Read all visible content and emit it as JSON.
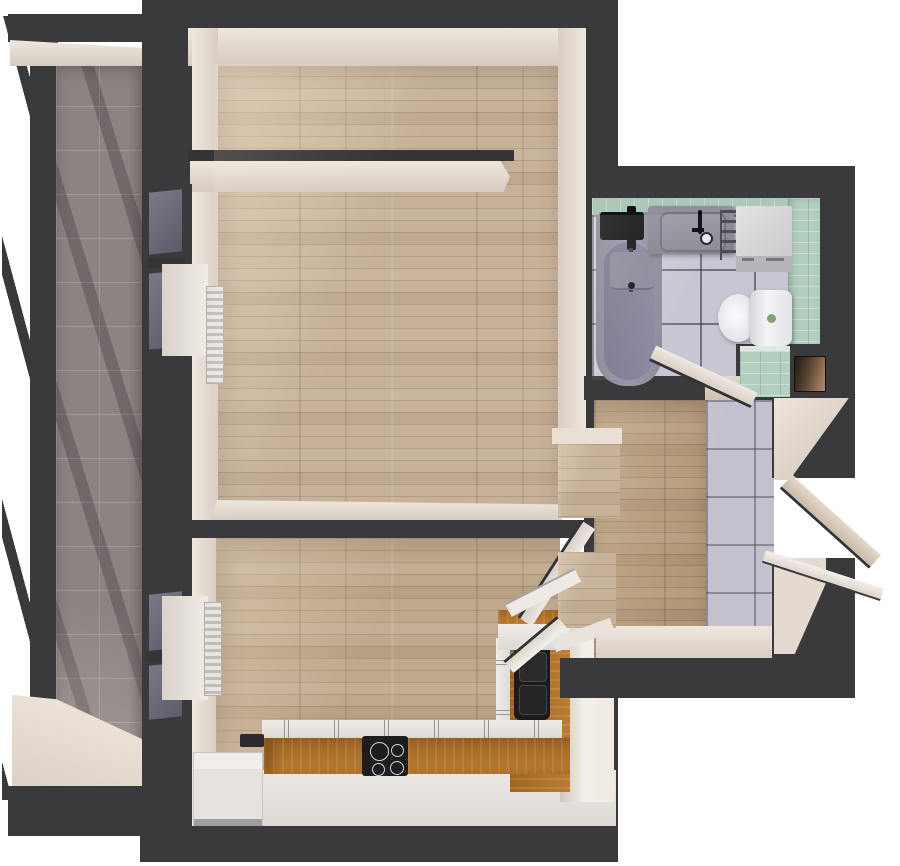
{
  "scene": {
    "description": "Top-down 3D render of a one-bedroom apartment floor plan",
    "background": "#ffffff",
    "view": "plan render, cut walls shown dark grey"
  },
  "palette": {
    "wall_cut": "#3a393b",
    "wall_face": "#e9dfd5",
    "wood_floor": "#c7b199",
    "hall_wood": "#b29878",
    "balcony_tile": "#8c8382",
    "bath_tile": "#c7c6d2",
    "green_tile": "#b2cfc0",
    "counter_wood": "#b5762b",
    "appliance_black": "#1d1d1f",
    "fixture_white": "#e9e6e3",
    "tub_gray": "#918ea0"
  },
  "rooms": {
    "balcony": {
      "label": "Balcony",
      "floor": "grey ceramic tile, full-height glazing"
    },
    "living_room": {
      "label": "Living room with niche",
      "floor": "light oak plank"
    },
    "bedroom_kitchen": {
      "label": "Bedroom with kitchen corner",
      "floor": "light oak plank"
    },
    "bathroom": {
      "label": "Bathroom",
      "floor": "white square tile, mint tile walls"
    },
    "hallway": {
      "label": "Hallway",
      "floor": "oak plank and white tile"
    }
  },
  "fixtures": {
    "glazing": "Balcony glazing",
    "window": "Window to balcony",
    "window_sill": "Window sill board",
    "radiator": "Panel radiator",
    "niche_wall": "Partial niche wall",
    "bathtub": "Bathtub with black shower set",
    "shower_tray": "Shower shelf",
    "vanity_sink": "Vanity sink with black faucet",
    "towel_rail": "Ladder towel rail",
    "washing_machine": "Washing machine",
    "toilet": "Toilet",
    "tile_ledge": "Tiled half-wall ledge",
    "service_hatch": "Wooden service hatch",
    "counter": "L-shaped kitchen counter, oak worktop",
    "cooktop": "Black cooktop with four burners",
    "kitchen_sink": "Black double-bowl sink",
    "tall_cabinet": "Tall kitchen cabinet",
    "side_cabinet": "White cabinet",
    "floor_vent": "Floor vent",
    "living_door": "Living room door, open",
    "bedroom_door": "Bedroom door, open",
    "bathroom_door": "Bathroom door, open",
    "entrance_door": "Entrance door, open outward",
    "entrance_sill": "Entrance threshold"
  }
}
